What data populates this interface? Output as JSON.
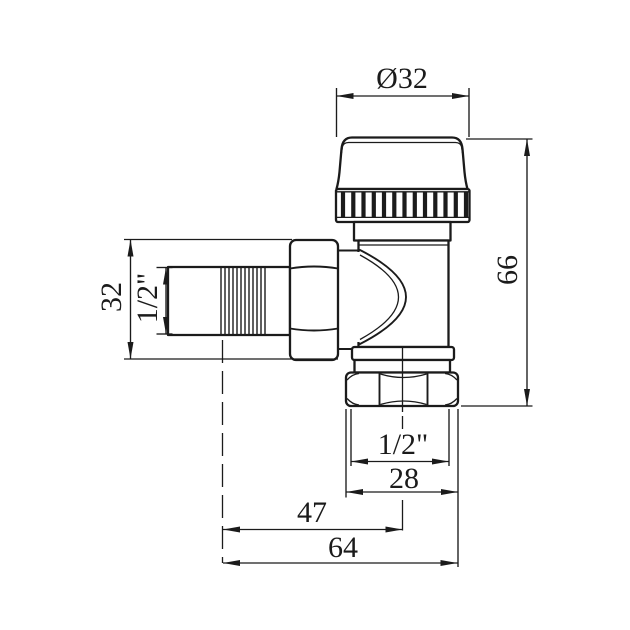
{
  "drawing": {
    "type": "technical dimension drawing",
    "subject": "angle radiator valve with thermostatic cap",
    "colors": {
      "ink": "#1b1b1b",
      "paper": "#ffffff"
    },
    "labels": {
      "cap_diameter": "Ø32",
      "total_height": "66",
      "side_connection_height": "32",
      "side_thread_size": "1/2\"",
      "bottom_thread_size": "1/2\"",
      "bottom_nut_width": "28",
      "axis_offset": "47",
      "total_length": "64"
    }
  }
}
